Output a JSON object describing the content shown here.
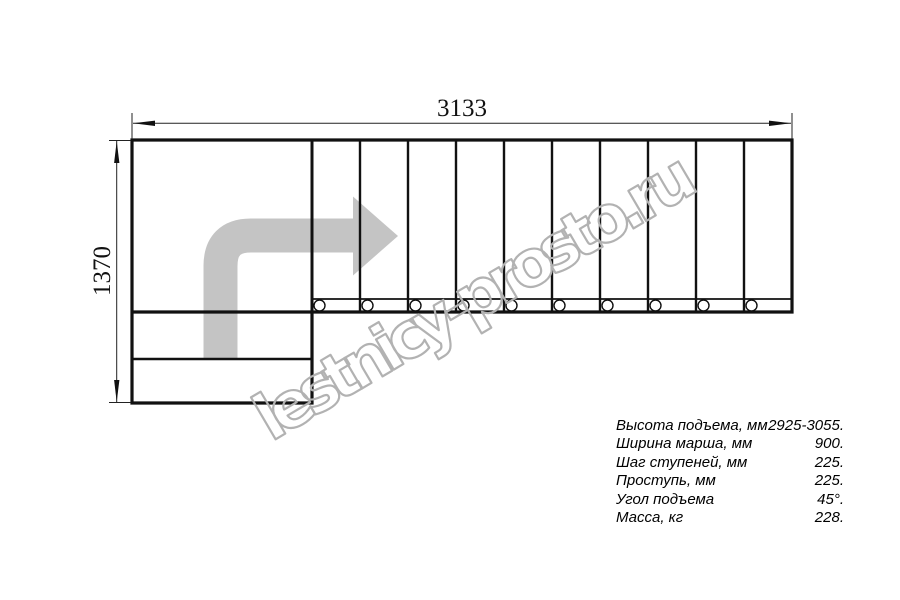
{
  "watermark": {
    "text": "lestnicy-prosto.ru",
    "color": "#b2b2b2"
  },
  "drawing": {
    "type": "staircase-plan-top-view",
    "width_dimension_label": "3133",
    "height_dimension_label": "1370",
    "upper_flight_treads": 10,
    "lower_steps": 2,
    "balusters_visible": 10,
    "line_color": "#111111",
    "route_arrow_color": "#c4c4c4"
  },
  "specs": {
    "rows": [
      {
        "label": "Высота подъема, мм",
        "value": "2925-3055."
      },
      {
        "label": "Ширина марша, мм",
        "value": "900."
      },
      {
        "label": "Шаг ступеней, мм",
        "value": "225."
      },
      {
        "label": "Проступь, мм",
        "value": "225."
      },
      {
        "label": "Угол подъема",
        "value": "45°."
      },
      {
        "label": "Масса, кг",
        "value": "228."
      }
    ]
  }
}
